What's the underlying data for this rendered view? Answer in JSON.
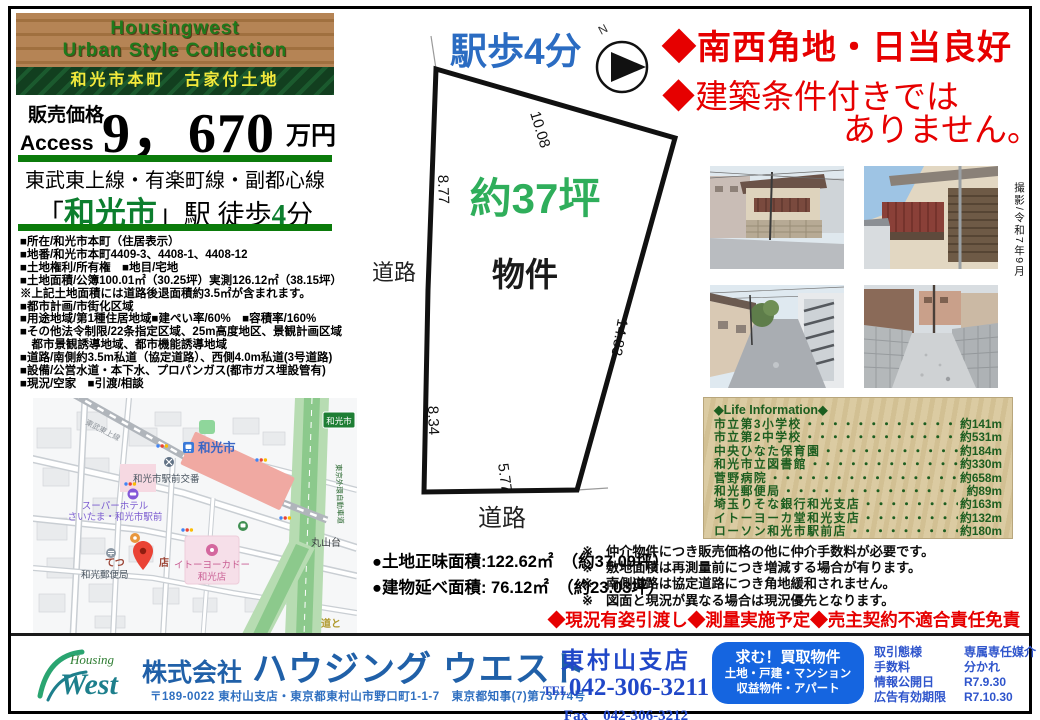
{
  "header": {
    "brand_line1": "Housingwest",
    "brand_line2": "Urban Style Collection",
    "ribbon": "和光市本町　古家付土地",
    "price_label": "販売価格",
    "access_label": "Access",
    "price_value": "9，670",
    "price_unit": "万円",
    "rail_lines": "東武東上線・有楽町線・副都心線",
    "station_open": "「",
    "station_name": "和光市",
    "station_close": "」駅 徒歩",
    "walk_min": "4",
    "walk_unit": "分"
  },
  "details": {
    "lines": [
      "■所在/和光市本町（住居表示）",
      "■地番/和光市本町4409-3、4408-1、4408-12",
      "■土地権利/所有権　■地目/宅地",
      "■土地面積/公簿100.01㎡（30.25坪）実測126.12㎡（38.15坪）",
      "※上記土地面積には道路後退面積約3.5㎡が含まれます。",
      "■都市計画/市街化区域",
      "■用途地域/第1種住居地域■建ぺい率/60%　■容積率/160%",
      "■その他法令制限/22条指定区域、25m高度地区、景観計画区域",
      "　都市景観誘導地域、都市機能誘導地域",
      "■道路/南側約3.5m私道（協定道路）、西側4.0m私道(3号道路)",
      "■設備/公営水道・本下水、プロパンガス(都市ガス埋設管有)",
      "■現況/空家　■引渡/相談"
    ]
  },
  "plot": {
    "title": "駅歩4分",
    "area": "約37坪",
    "bukken": "物件",
    "road_left": "道路",
    "road_bottom": "道路",
    "compass_n": "N",
    "edges": {
      "top": "10.08",
      "left_upper": "8.77",
      "right": "14.83",
      "left_lower": "8.34",
      "bottom": "5.77"
    }
  },
  "areas": {
    "land": "●土地正味面積:122.62㎡　（約37.09坪）",
    "building": "●建物延べ面積: 76.12㎡　（約23.03坪）"
  },
  "headlines": {
    "line1": "◆南西角地・日当良好",
    "line2a": "◆建築条件付きでは",
    "line2b": "ありません。"
  },
  "photos": {
    "caption": "撮影/令和7年9月"
  },
  "map": {
    "rail": "東武東上線",
    "station": "和光市",
    "sign": "和光市",
    "koban": "和光市駅前交番",
    "hotel1": "スーパーホテル",
    "hotel2": "さいたま・和光市駅前",
    "tetsu_a": "てつ",
    "tetsu_b": "店",
    "post": "和光郵便局",
    "yokado1": "イトーヨーカドー",
    "yokado2": "和光店",
    "maruyama": "丸山台",
    "gaikan": "東京外環自動車道",
    "michi": "道と"
  },
  "life": {
    "title": "◆Life Information◆",
    "items": [
      {
        "label": "市立第3小学校",
        "distance": "約141m"
      },
      {
        "label": "市立第2中学校",
        "distance": "約531m"
      },
      {
        "label": "中央ひなた保育園",
        "distance": "約184m"
      },
      {
        "label": "和光市立図書館",
        "distance": "約330m"
      },
      {
        "label": "菅野病院",
        "distance": "約658m"
      },
      {
        "label": "和光郵便局",
        "distance": "約89m"
      },
      {
        "label": "埼玉りそな銀行和光支店",
        "distance": "約163m"
      },
      {
        "label": "イトーヨーカ堂和光支店",
        "distance": "約132m"
      },
      {
        "label": "ローソン和光市駅前店",
        "distance": "約180m"
      }
    ]
  },
  "notes": {
    "mark": "※",
    "items": [
      "仲介物件につき販売価格の他に仲介手数料が必要です。",
      "敷地面積は再測量前につき増減する場合が有ります。",
      "南側道路は協定道路につき角地緩和されません。",
      "図面と現況が異なる場合は現況優先となります。"
    ]
  },
  "red_banner": "◆現況有姿引渡し◆測量実施予定◆売主契約不適合責任免責",
  "footer": {
    "logo_top": "Housing",
    "logo_main": "West",
    "company_prefix": "株式会社",
    "company_name": "ハウジング ウエスト",
    "address": "〒189-0022 東村山支店・東京都東村山市野口町1-1-7　東京都知事(7)第73774号",
    "branch": "東村山支店",
    "tel_label": "TEL",
    "tel_number": "042-306-3211",
    "fax_line": "Fax　042-306-3212",
    "bluebox": [
      "求む！買取物件",
      "土地・戸建・マンション",
      "収益物件・アパート"
    ],
    "table": [
      {
        "label": "取引態様",
        "value": "専属専任媒介"
      },
      {
        "label": "手数料",
        "value": "分かれ"
      },
      {
        "label": "情報公開日",
        "value": "R7.9.30"
      },
      {
        "label": "広告有効期限",
        "value": "R7.10.30"
      }
    ]
  },
  "colors": {
    "accent_green": "#0b7b0b",
    "headline_red": "#e60000",
    "walk_blue": "#2b6cc2",
    "tsubo_green": "#2fae5b",
    "footer_blue": "#2060a8",
    "bluebox_bg": "#1565e0",
    "life_bg": "#d6c69a",
    "life_text": "#1c5e20"
  }
}
